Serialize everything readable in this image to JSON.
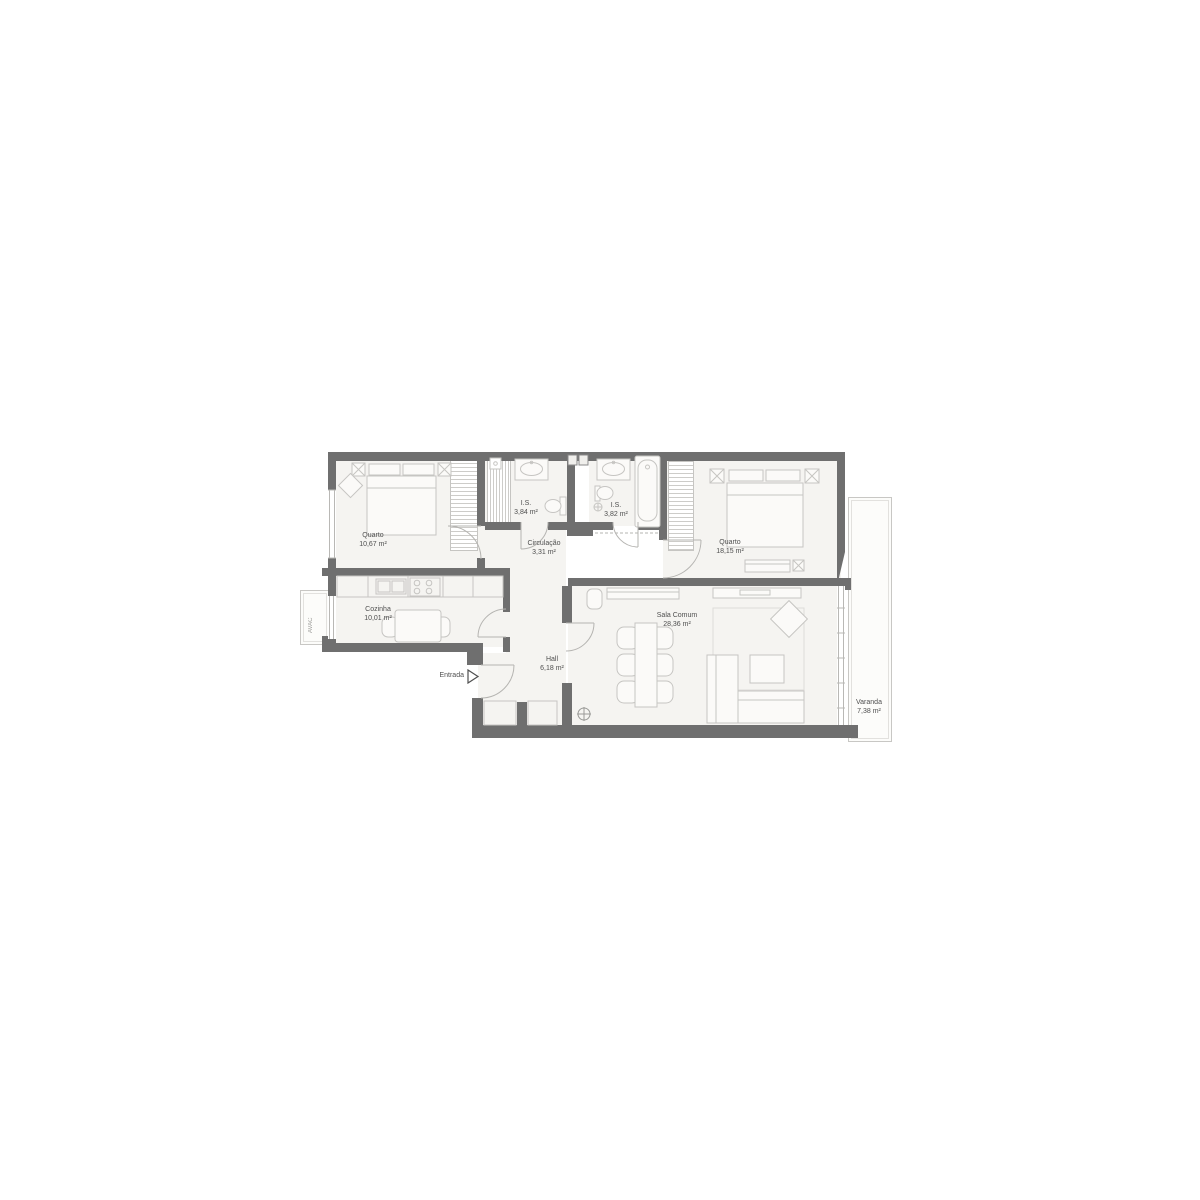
{
  "rooms": {
    "quarto1": {
      "name": "Quarto",
      "area": "10,67 m²"
    },
    "is1": {
      "name": "I.S.",
      "area": "3,84 m²"
    },
    "is2": {
      "name": "I.S.",
      "area": "3,82 m²"
    },
    "quarto2": {
      "name": "Quarto",
      "area": "18,15 m²"
    },
    "circulacao": {
      "name": "Circulação",
      "area": "3,31 m²"
    },
    "cozinha": {
      "name": "Cozinha",
      "area": "10,01 m²"
    },
    "hall": {
      "name": "Hall",
      "area": "6,18 m²"
    },
    "sala": {
      "name": "Sala Comum",
      "area": "28,36 m²"
    },
    "varanda": {
      "name": "Varanda",
      "area": "7,38 m²"
    }
  },
  "annotations": {
    "entrance": "Entrada",
    "hvac": "AVAC"
  },
  "colors": {
    "wall": "#6f6f6f",
    "floor": "#f5f4f1",
    "furniture_line": "#c6c5c2",
    "text": "#4f4f4f"
  }
}
